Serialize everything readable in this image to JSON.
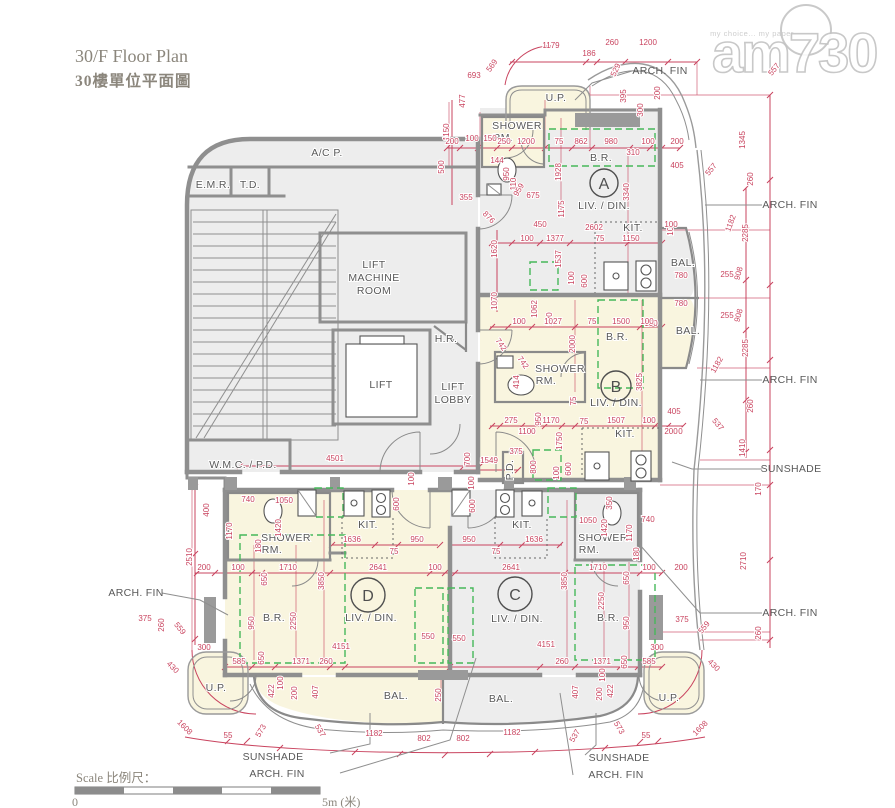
{
  "page": {
    "title_en": "30/F Floor Plan",
    "title_zh": "30樓單位平面圖"
  },
  "watermark": {
    "brand": "am730",
    "tagline": "my choice... my paper"
  },
  "scale": {
    "label": "Scale 比例尺：",
    "start": "0",
    "end": "5m (米)"
  },
  "colors": {
    "dimension_red": "#c9445f",
    "green_dashed": "#46b85a",
    "wall_gray": "#8f8f8f",
    "room_cream": "#f9f5df",
    "room_gray": "#ededed",
    "label_gray": "#595959",
    "title_gray": "#8b867c"
  },
  "plan": {
    "units": [
      {
        "l": "A",
        "x": 604,
        "y": 183,
        "r": 14
      },
      {
        "l": "B",
        "x": 616,
        "y": 386,
        "r": 15
      },
      {
        "l": "C",
        "x": 515,
        "y": 594,
        "r": 17
      },
      {
        "l": "D",
        "x": 368,
        "y": 595,
        "r": 17
      }
    ],
    "rooms": [
      {
        "t": "A/C P.",
        "x": 327,
        "y": 156
      },
      {
        "t": "E.M.R.",
        "x": 213,
        "y": 188
      },
      {
        "t": "T.D.",
        "x": 250,
        "y": 188
      },
      {
        "t": "LIFT",
        "x": 374,
        "y": 268
      },
      {
        "t": "MACHINE",
        "x": 374,
        "y": 281
      },
      {
        "t": "ROOM",
        "x": 374,
        "y": 294
      },
      {
        "t": "LIFT",
        "x": 381,
        "y": 388
      },
      {
        "t": "H.R.",
        "x": 446,
        "y": 342
      },
      {
        "t": "LIFT",
        "x": 453,
        "y": 390
      },
      {
        "t": "LOBBY",
        "x": 453,
        "y": 403
      },
      {
        "t": "W.M.C. / P.D.",
        "x": 243,
        "y": 468
      },
      {
        "t": "U.P.",
        "x": 556,
        "y": 101
      },
      {
        "t": "SHOWER",
        "x": 517,
        "y": 129
      },
      {
        "t": "RM.",
        "x": 503,
        "y": 141
      },
      {
        "t": "B.R.",
        "x": 601,
        "y": 161
      },
      {
        "t": "LIV. / DIN.",
        "x": 604,
        "y": 209
      },
      {
        "t": "KIT.",
        "x": 633,
        "y": 231
      },
      {
        "t": "BAL.",
        "x": 683,
        "y": 266
      },
      {
        "t": "B.R.",
        "x": 617,
        "y": 340
      },
      {
        "t": "SHOWER",
        "x": 560,
        "y": 372
      },
      {
        "t": "RM.",
        "x": 546,
        "y": 384
      },
      {
        "t": "LIV. / DIN.",
        "x": 616,
        "y": 406
      },
      {
        "t": "KIT.",
        "x": 625,
        "y": 437
      },
      {
        "t": "BAL.",
        "x": 688,
        "y": 334
      },
      {
        "t": "P.D.",
        "x": 513,
        "y": 470,
        "a": -90
      },
      {
        "t": "SHOWER",
        "x": 286,
        "y": 541
      },
      {
        "t": "RM.",
        "x": 272,
        "y": 553
      },
      {
        "t": "KIT.",
        "x": 368,
        "y": 528
      },
      {
        "t": "B.R.",
        "x": 274,
        "y": 621
      },
      {
        "t": "LIV. / DIN.",
        "x": 371,
        "y": 621
      },
      {
        "t": "KIT.",
        "x": 522,
        "y": 528
      },
      {
        "t": "SHOWER",
        "x": 603,
        "y": 541
      },
      {
        "t": "RM.",
        "x": 589,
        "y": 553
      },
      {
        "t": "B.R.",
        "x": 608,
        "y": 621
      },
      {
        "t": "LIV. / DIN.",
        "x": 517,
        "y": 622
      },
      {
        "t": "BAL.",
        "x": 396,
        "y": 699
      },
      {
        "t": "BAL.",
        "x": 501,
        "y": 702
      },
      {
        "t": "U.P.",
        "x": 216,
        "y": 691
      },
      {
        "t": "U.P.",
        "x": 669,
        "y": 701
      }
    ],
    "callouts": [
      {
        "t": "ARCH. FIN",
        "x": 660,
        "y": 74
      },
      {
        "t": "ARCH. FIN",
        "x": 790,
        "y": 208
      },
      {
        "t": "ARCH. FIN",
        "x": 790,
        "y": 383
      },
      {
        "t": "SUNSHADE",
        "x": 791,
        "y": 472
      },
      {
        "t": "ARCH. FIN",
        "x": 790,
        "y": 616
      },
      {
        "t": "ARCH. FIN",
        "x": 136,
        "y": 596
      },
      {
        "t": "SUNSHADE",
        "x": 273,
        "y": 760
      },
      {
        "t": "ARCH. FIN",
        "x": 277,
        "y": 777
      },
      {
        "t": "SUNSHADE",
        "x": 619,
        "y": 761
      },
      {
        "t": "ARCH. FIN",
        "x": 616,
        "y": 778
      }
    ],
    "dims": [
      {
        "t": "1179",
        "x": 551,
        "y": 48
      },
      {
        "t": "186",
        "x": 589,
        "y": 56
      },
      {
        "t": "260",
        "x": 612,
        "y": 45
      },
      {
        "t": "1200",
        "x": 648,
        "y": 45
      },
      {
        "t": "693",
        "x": 474,
        "y": 78
      },
      {
        "t": "569",
        "x": 494,
        "y": 67,
        "a": -55
      },
      {
        "t": "529",
        "x": 618,
        "y": 71,
        "a": -65
      },
      {
        "t": "477",
        "x": 465,
        "y": 101,
        "a": -90
      },
      {
        "t": "1150",
        "x": 449,
        "y": 132,
        "a": -90
      },
      {
        "t": "395",
        "x": 626,
        "y": 96,
        "a": -90
      },
      {
        "t": "200",
        "x": 660,
        "y": 93,
        "a": -90
      },
      {
        "t": "300",
        "x": 643,
        "y": 110,
        "a": -90
      },
      {
        "t": "1345",
        "x": 745,
        "y": 140,
        "a": -90
      },
      {
        "t": "557",
        "x": 776,
        "y": 71,
        "a": -50
      },
      {
        "t": "200",
        "x": 452,
        "y": 144
      },
      {
        "t": "100",
        "x": 472,
        "y": 141
      },
      {
        "t": "150",
        "x": 490,
        "y": 141
      },
      {
        "t": "250",
        "x": 504,
        "y": 144
      },
      {
        "t": "1200",
        "x": 526,
        "y": 144
      },
      {
        "t": "75",
        "x": 559,
        "y": 144
      },
      {
        "t": "862",
        "x": 581,
        "y": 144
      },
      {
        "t": "980",
        "x": 611,
        "y": 144
      },
      {
        "t": "100",
        "x": 648,
        "y": 144
      },
      {
        "t": "310",
        "x": 633,
        "y": 155
      },
      {
        "t": "200",
        "x": 677,
        "y": 144
      },
      {
        "t": "405",
        "x": 677,
        "y": 168
      },
      {
        "t": "557",
        "x": 713,
        "y": 171,
        "a": -50
      },
      {
        "t": "500",
        "x": 444,
        "y": 167,
        "a": -90
      },
      {
        "t": "144",
        "x": 497,
        "y": 163
      },
      {
        "t": "950",
        "x": 509,
        "y": 174,
        "a": -90
      },
      {
        "t": "110",
        "x": 516,
        "y": 184,
        "a": -90
      },
      {
        "t": "1928",
        "x": 561,
        "y": 172,
        "a": -90
      },
      {
        "t": "3340",
        "x": 629,
        "y": 192,
        "a": -90
      },
      {
        "t": "355",
        "x": 466,
        "y": 200
      },
      {
        "t": "876",
        "x": 487,
        "y": 219,
        "a": 45
      },
      {
        "t": "959",
        "x": 521,
        "y": 191,
        "a": -60
      },
      {
        "t": "675",
        "x": 533,
        "y": 198
      },
      {
        "t": "1175",
        "x": 564,
        "y": 209,
        "a": -90
      },
      {
        "t": "260",
        "x": 753,
        "y": 179,
        "a": -90
      },
      {
        "t": "2285",
        "x": 748,
        "y": 233,
        "a": -90
      },
      {
        "t": "1182",
        "x": 733,
        "y": 224,
        "a": -70
      },
      {
        "t": "908",
        "x": 741,
        "y": 274,
        "a": -75
      },
      {
        "t": "255",
        "x": 727,
        "y": 277
      },
      {
        "t": "100",
        "x": 673,
        "y": 229,
        "a": -90
      },
      {
        "t": "780",
        "x": 681,
        "y": 278
      },
      {
        "t": "780",
        "x": 681,
        "y": 306
      },
      {
        "t": "255",
        "x": 727,
        "y": 318
      },
      {
        "t": "908",
        "x": 741,
        "y": 316,
        "a": -75
      },
      {
        "t": "2285",
        "x": 748,
        "y": 348,
        "a": -90
      },
      {
        "t": "1182",
        "x": 719,
        "y": 366,
        "a": -60
      },
      {
        "t": "260",
        "x": 753,
        "y": 406,
        "a": -90
      },
      {
        "t": "1410",
        "x": 745,
        "y": 448,
        "a": -90
      },
      {
        "t": "100",
        "x": 651,
        "y": 326
      },
      {
        "t": "405",
        "x": 674,
        "y": 414
      },
      {
        "t": "200",
        "x": 676,
        "y": 434
      },
      {
        "t": "537",
        "x": 716,
        "y": 426,
        "a": 50
      },
      {
        "t": "170",
        "x": 761,
        "y": 489,
        "a": -90
      },
      {
        "t": "2710",
        "x": 746,
        "y": 561,
        "a": -90
      },
      {
        "t": "260",
        "x": 761,
        "y": 633,
        "a": -90
      },
      {
        "t": "450",
        "x": 540,
        "y": 227
      },
      {
        "t": "2602",
        "x": 594,
        "y": 230
      },
      {
        "t": "100",
        "x": 671,
        "y": 227
      },
      {
        "t": "1620",
        "x": 497,
        "y": 249,
        "a": -90
      },
      {
        "t": "100",
        "x": 527,
        "y": 241
      },
      {
        "t": "1377",
        "x": 555,
        "y": 241
      },
      {
        "t": "75",
        "x": 600,
        "y": 241
      },
      {
        "t": "1150",
        "x": 631,
        "y": 241
      },
      {
        "t": "1537",
        "x": 561,
        "y": 259,
        "a": -90
      },
      {
        "t": "100",
        "x": 574,
        "y": 278,
        "a": -90
      },
      {
        "t": "600",
        "x": 587,
        "y": 281,
        "a": -90
      },
      {
        "t": "1070",
        "x": 497,
        "y": 301,
        "a": -90
      },
      {
        "t": "1062",
        "x": 537,
        "y": 309,
        "a": -90
      },
      {
        "t": "100",
        "x": 552,
        "y": 319,
        "a": -90
      },
      {
        "t": "100",
        "x": 519,
        "y": 324
      },
      {
        "t": "1027",
        "x": 553,
        "y": 324
      },
      {
        "t": "75",
        "x": 592,
        "y": 324
      },
      {
        "t": "1500",
        "x": 621,
        "y": 324
      },
      {
        "t": "100",
        "x": 647,
        "y": 324
      },
      {
        "t": "2000",
        "x": 575,
        "y": 344,
        "a": -90
      },
      {
        "t": "742",
        "x": 499,
        "y": 346,
        "a": 55
      },
      {
        "t": "742",
        "x": 521,
        "y": 364,
        "a": 55
      },
      {
        "t": "414",
        "x": 519,
        "y": 382,
        "a": -90
      },
      {
        "t": "950",
        "x": 541,
        "y": 419,
        "a": -90
      },
      {
        "t": "75",
        "x": 576,
        "y": 401,
        "a": -90
      },
      {
        "t": "3825",
        "x": 642,
        "y": 382,
        "a": -90
      },
      {
        "t": "275",
        "x": 511,
        "y": 423
      },
      {
        "t": "1170",
        "x": 551,
        "y": 423
      },
      {
        "t": "1100",
        "x": 527,
        "y": 434
      },
      {
        "t": "75",
        "x": 584,
        "y": 424
      },
      {
        "t": "1507",
        "x": 616,
        "y": 423
      },
      {
        "t": "100",
        "x": 649,
        "y": 423
      },
      {
        "t": "200",
        "x": 671,
        "y": 434
      },
      {
        "t": "1750",
        "x": 562,
        "y": 441,
        "a": -90
      },
      {
        "t": "800",
        "x": 536,
        "y": 467,
        "a": -90
      },
      {
        "t": "600",
        "x": 571,
        "y": 469,
        "a": -90
      },
      {
        "t": "100",
        "x": 559,
        "y": 473,
        "a": -90
      },
      {
        "t": "375",
        "x": 516,
        "y": 454
      },
      {
        "t": "700",
        "x": 470,
        "y": 459,
        "a": -90
      },
      {
        "t": "1549",
        "x": 489,
        "y": 463
      },
      {
        "t": "4501",
        "x": 335,
        "y": 461
      },
      {
        "t": "100",
        "x": 414,
        "y": 479,
        "a": -90
      },
      {
        "t": "100",
        "x": 474,
        "y": 483,
        "a": -90
      },
      {
        "t": "600",
        "x": 475,
        "y": 506,
        "a": -90
      },
      {
        "t": "600",
        "x": 399,
        "y": 504,
        "a": -90
      },
      {
        "t": "740",
        "x": 248,
        "y": 502
      },
      {
        "t": "1050",
        "x": 284,
        "y": 503
      },
      {
        "t": "400",
        "x": 209,
        "y": 510,
        "a": -90
      },
      {
        "t": "1170",
        "x": 232,
        "y": 531,
        "a": -90
      },
      {
        "t": "1420",
        "x": 281,
        "y": 528,
        "a": -90
      },
      {
        "t": "180",
        "x": 261,
        "y": 546,
        "a": -90
      },
      {
        "t": "1636",
        "x": 352,
        "y": 542
      },
      {
        "t": "950",
        "x": 417,
        "y": 542
      },
      {
        "t": "75",
        "x": 394,
        "y": 554
      },
      {
        "t": "200",
        "x": 204,
        "y": 570
      },
      {
        "t": "100",
        "x": 238,
        "y": 570
      },
      {
        "t": "1710",
        "x": 288,
        "y": 570
      },
      {
        "t": "2641",
        "x": 378,
        "y": 570
      },
      {
        "t": "100",
        "x": 435,
        "y": 570
      },
      {
        "t": "650",
        "x": 267,
        "y": 579,
        "a": -90
      },
      {
        "t": "3850",
        "x": 324,
        "y": 581,
        "a": -90
      },
      {
        "t": "950",
        "x": 254,
        "y": 623,
        "a": -90
      },
      {
        "t": "2250",
        "x": 296,
        "y": 621,
        "a": -90
      },
      {
        "t": "550",
        "x": 428,
        "y": 639
      },
      {
        "t": "4151",
        "x": 341,
        "y": 649
      },
      {
        "t": "300",
        "x": 204,
        "y": 650
      },
      {
        "t": "585",
        "x": 239,
        "y": 664
      },
      {
        "t": "650",
        "x": 264,
        "y": 658,
        "a": -90
      },
      {
        "t": "1371",
        "x": 301,
        "y": 664
      },
      {
        "t": "260",
        "x": 326,
        "y": 664
      },
      {
        "t": "2510",
        "x": 192,
        "y": 557,
        "a": -90
      },
      {
        "t": "375",
        "x": 145,
        "y": 621
      },
      {
        "t": "260",
        "x": 164,
        "y": 625,
        "a": -90
      },
      {
        "t": "559",
        "x": 178,
        "y": 630,
        "a": 50
      },
      {
        "t": "430",
        "x": 171,
        "y": 669,
        "a": 45
      },
      {
        "t": "950",
        "x": 469,
        "y": 542
      },
      {
        "t": "1636",
        "x": 534,
        "y": 542
      },
      {
        "t": "75",
        "x": 496,
        "y": 554
      },
      {
        "t": "1050",
        "x": 588,
        "y": 523
      },
      {
        "t": "740",
        "x": 648,
        "y": 522
      },
      {
        "t": "350",
        "x": 612,
        "y": 503,
        "a": -90
      },
      {
        "t": "1420",
        "x": 607,
        "y": 528,
        "a": -90
      },
      {
        "t": "1170",
        "x": 632,
        "y": 533,
        "a": -90
      },
      {
        "t": "180",
        "x": 639,
        "y": 554,
        "a": -90
      },
      {
        "t": "2641",
        "x": 511,
        "y": 570
      },
      {
        "t": "1710",
        "x": 598,
        "y": 570
      },
      {
        "t": "100",
        "x": 649,
        "y": 570
      },
      {
        "t": "200",
        "x": 681,
        "y": 570
      },
      {
        "t": "650",
        "x": 629,
        "y": 578,
        "a": -90
      },
      {
        "t": "3850",
        "x": 567,
        "y": 581,
        "a": -90
      },
      {
        "t": "2250",
        "x": 604,
        "y": 601,
        "a": -90
      },
      {
        "t": "950",
        "x": 629,
        "y": 623,
        "a": -90
      },
      {
        "t": "550",
        "x": 459,
        "y": 641
      },
      {
        "t": "4151",
        "x": 546,
        "y": 647
      },
      {
        "t": "260",
        "x": 562,
        "y": 664
      },
      {
        "t": "1371",
        "x": 602,
        "y": 664
      },
      {
        "t": "650",
        "x": 627,
        "y": 662,
        "a": -90
      },
      {
        "t": "585",
        "x": 649,
        "y": 664
      },
      {
        "t": "300",
        "x": 657,
        "y": 650
      },
      {
        "t": "375",
        "x": 682,
        "y": 622
      },
      {
        "t": "559",
        "x": 706,
        "y": 629,
        "a": -50
      },
      {
        "t": "1608",
        "x": 183,
        "y": 729,
        "a": 45
      },
      {
        "t": "55",
        "x": 228,
        "y": 738
      },
      {
        "t": "573",
        "x": 263,
        "y": 732,
        "a": -60
      },
      {
        "t": "537",
        "x": 318,
        "y": 732,
        "a": 60
      },
      {
        "t": "1182",
        "x": 374,
        "y": 736
      },
      {
        "t": "802",
        "x": 424,
        "y": 741
      },
      {
        "t": "802",
        "x": 463,
        "y": 741
      },
      {
        "t": "1182",
        "x": 512,
        "y": 735
      },
      {
        "t": "537",
        "x": 577,
        "y": 737,
        "a": -60
      },
      {
        "t": "573",
        "x": 617,
        "y": 729,
        "a": 60
      },
      {
        "t": "55",
        "x": 646,
        "y": 738
      },
      {
        "t": "1608",
        "x": 702,
        "y": 730,
        "a": -45
      },
      {
        "t": "430",
        "x": 712,
        "y": 667,
        "a": 45
      },
      {
        "t": "422",
        "x": 274,
        "y": 691,
        "a": -90
      },
      {
        "t": "100",
        "x": 283,
        "y": 683,
        "a": -90
      },
      {
        "t": "200",
        "x": 297,
        "y": 693,
        "a": -90
      },
      {
        "t": "407",
        "x": 318,
        "y": 692,
        "a": -90
      },
      {
        "t": "250",
        "x": 441,
        "y": 695,
        "a": -90
      },
      {
        "t": "407",
        "x": 578,
        "y": 692,
        "a": -90
      },
      {
        "t": "200",
        "x": 602,
        "y": 694,
        "a": -90
      },
      {
        "t": "422",
        "x": 613,
        "y": 691,
        "a": -90
      },
      {
        "t": "100",
        "x": 605,
        "y": 675,
        "a": -90
      }
    ]
  }
}
